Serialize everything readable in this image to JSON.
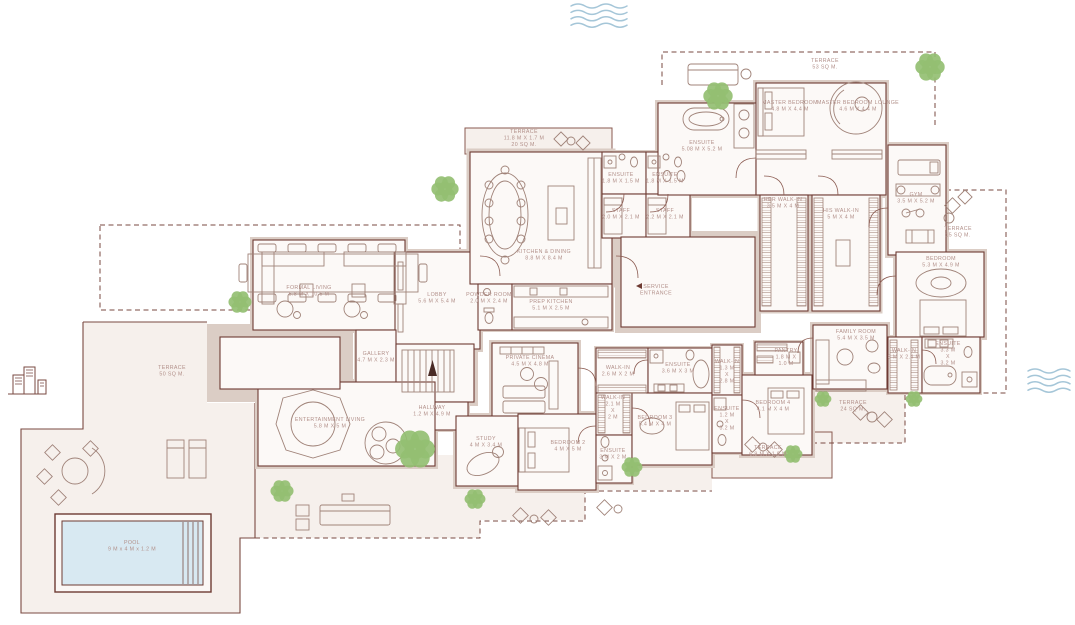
{
  "colors": {
    "wall": "#6e3b33",
    "wall_fill": "#dbcdc5",
    "room_fill": "#fcf9f7",
    "ground": "#f6f0ec",
    "label_text": "#b2908a",
    "tree_green": "#94bf72",
    "pool_water": "#d8e9f2",
    "wave_blue": "#a5c6d8"
  },
  "plan": {
    "labels": [
      {
        "id": "terrace-left",
        "lines": [
          "TERRACE",
          "50 SQ M."
        ],
        "x": 172,
        "y": 369
      },
      {
        "id": "formal-living",
        "lines": [
          "FORMAL LIVING",
          "5.8 M X 10.5 M"
        ],
        "x": 309,
        "y": 289
      },
      {
        "id": "gallery",
        "lines": [
          "GALLERY",
          "4.7 M X 2.3 M"
        ],
        "x": 376,
        "y": 355
      },
      {
        "id": "hallway",
        "lines": [
          "HALLWAY",
          "1.2 M X 4.9 M"
        ],
        "x": 432,
        "y": 409
      },
      {
        "id": "lobby",
        "lines": [
          "LOBBY",
          "5.6 M X 5.4 M"
        ],
        "x": 437,
        "y": 296
      },
      {
        "id": "entertainment-living",
        "lines": [
          "ENTERTAINMENT LIVING",
          "5.8 M X 5 M"
        ],
        "x": 330,
        "y": 421
      },
      {
        "id": "powder-room",
        "lines": [
          "POWDER ROOM",
          "2.0 M X 2.4 M"
        ],
        "x": 489,
        "y": 296
      },
      {
        "id": "prep-kitchen",
        "lines": [
          "PREP KITCHEN",
          "5.1 M X 2.5 M"
        ],
        "x": 551,
        "y": 303
      },
      {
        "id": "kitchen-dining",
        "lines": [
          "KITCHEN & DINING",
          "8.8 M X 8.4 M"
        ],
        "x": 544,
        "y": 253
      },
      {
        "id": "terrace-kitchen",
        "lines": [
          "TERRACE",
          "11.8 M X 1.7 M",
          "20 SQ M."
        ],
        "x": 524,
        "y": 133
      },
      {
        "id": "ensuite-staff-left",
        "lines": [
          "ENSUITE",
          "1.8 M X 1.5 M"
        ],
        "x": 621,
        "y": 176
      },
      {
        "id": "ensuite-staff-right",
        "lines": [
          "ENSUITE",
          "1.8 M X 1.5 M"
        ],
        "x": 665,
        "y": 176
      },
      {
        "id": "staff-left",
        "lines": [
          "STAFF",
          "2.0 M X 2.1 M"
        ],
        "x": 621,
        "y": 212
      },
      {
        "id": "staff-right",
        "lines": [
          "STAFF",
          "2.2 M X 2.1 M"
        ],
        "x": 665,
        "y": 212
      },
      {
        "id": "service-entrance",
        "lines": [
          "SERVICE",
          "ENTRANCE"
        ],
        "x": 656,
        "y": 288,
        "arrow": "left"
      },
      {
        "id": "master-bedroom",
        "lines": [
          "MASTER BEDROOM",
          "4.8 M X 4.4 M"
        ],
        "x": 790,
        "y": 104
      },
      {
        "id": "master-bedroom-lounge",
        "lines": [
          "MASTER BEDROOM LOUNGE",
          "4.6 M X 4.4 M"
        ],
        "x": 858,
        "y": 104
      },
      {
        "id": "terrace-master",
        "lines": [
          "TERRACE",
          "53 SQ M."
        ],
        "x": 825,
        "y": 62
      },
      {
        "id": "ensuite-master",
        "lines": [
          "ENSUITE",
          "5.08 M X 5.2 M"
        ],
        "x": 702,
        "y": 144
      },
      {
        "id": "her-walk-in",
        "lines": [
          "HER WALK-IN",
          "3.5 M X 4 M"
        ],
        "x": 783,
        "y": 201
      },
      {
        "id": "his-walk-in",
        "lines": [
          "HIS WALK-IN",
          "5 M X 4 M"
        ],
        "x": 841,
        "y": 212
      },
      {
        "id": "gym",
        "lines": [
          "GYM",
          "3.5 M X 5.2 M"
        ],
        "x": 916,
        "y": 196
      },
      {
        "id": "terrace-gym",
        "lines": [
          "TERRACE",
          "15 SQ M."
        ],
        "x": 958,
        "y": 230
      },
      {
        "id": "bedroom-right",
        "lines": [
          "BEDROOM",
          "5.3 M X 4.9 M"
        ],
        "x": 941,
        "y": 260
      },
      {
        "id": "walk-in-bedroom-right",
        "lines": [
          "WALK-IN",
          "3 M X 2.4 M"
        ],
        "x": 904,
        "y": 352
      },
      {
        "id": "ensuite-bedroom-right",
        "lines": [
          "ENSUITE",
          "3.3 M",
          "X",
          "3.2 M"
        ],
        "x": 948,
        "y": 345
      },
      {
        "id": "family-room",
        "lines": [
          "FAMILY ROOM",
          "5.4 M X 3.5 M"
        ],
        "x": 856,
        "y": 333
      },
      {
        "id": "pantry",
        "lines": [
          "PANTRY",
          "1.8 M X",
          "1.0 M"
        ],
        "x": 786,
        "y": 352
      },
      {
        "id": "bedroom-4",
        "lines": [
          "BEDROOM 4",
          "4.1 M X 4 M"
        ],
        "x": 773,
        "y": 404
      },
      {
        "id": "walk-in-4",
        "lines": [
          "WALK-IN",
          "1.3 M",
          "X",
          "2.8 M"
        ],
        "x": 727,
        "y": 363
      },
      {
        "id": "ensuite-4",
        "lines": [
          "ENSUITE",
          "1.2 M",
          "X",
          "3.2 M"
        ],
        "x": 727,
        "y": 410
      },
      {
        "id": "bedroom-3",
        "lines": [
          "BEDROOM 3",
          "5.4 M X 4 M"
        ],
        "x": 655,
        "y": 419
      },
      {
        "id": "ensuite-3",
        "lines": [
          "ENSUITE",
          "3.6 M X 3 M"
        ],
        "x": 678,
        "y": 366
      },
      {
        "id": "walk-in-3",
        "lines": [
          "WALK-IN",
          "2.6 M X 2 M"
        ],
        "x": 618,
        "y": 369
      },
      {
        "id": "walk-in-2",
        "lines": [
          "WALK-IN",
          "2.1 M",
          "X",
          "2 M"
        ],
        "x": 613,
        "y": 399
      },
      {
        "id": "ensuite-2",
        "lines": [
          "ENSUITE",
          "3 M X 2 M"
        ],
        "x": 613,
        "y": 452
      },
      {
        "id": "bedroom-2",
        "lines": [
          "BEDROOM 2",
          "4 M X 5 M"
        ],
        "x": 568,
        "y": 444
      },
      {
        "id": "study",
        "lines": [
          "STUDY",
          "4 M X 3.4 M"
        ],
        "x": 486,
        "y": 440
      },
      {
        "id": "private-cinema",
        "lines": [
          "PRIVATE CINEMA",
          "4.5 M X 4.8 M"
        ],
        "x": 530,
        "y": 359
      },
      {
        "id": "terrace-bedrooms",
        "lines": [
          "TERRACE",
          "6.9 M X 1.8 M"
        ],
        "x": 768,
        "y": 449
      },
      {
        "id": "terrace-family",
        "lines": [
          "TERRACE",
          "24 SQ M."
        ],
        "x": 853,
        "y": 404
      },
      {
        "id": "pool",
        "lines": [
          "POOL",
          "9 M x 4 M x 1.2 M"
        ],
        "x": 132,
        "y": 544
      }
    ],
    "trees": [
      {
        "x": 445,
        "y": 189,
        "r": 13
      },
      {
        "x": 240,
        "y": 302,
        "r": 11
      },
      {
        "x": 718,
        "y": 96,
        "r": 14
      },
      {
        "x": 930,
        "y": 67,
        "r": 14
      },
      {
        "x": 415,
        "y": 449,
        "r": 19
      },
      {
        "x": 282,
        "y": 491,
        "r": 11
      },
      {
        "x": 475,
        "y": 499,
        "r": 10
      },
      {
        "x": 632,
        "y": 467,
        "r": 10
      },
      {
        "x": 793,
        "y": 454,
        "r": 9
      },
      {
        "x": 823,
        "y": 399,
        "r": 8
      },
      {
        "x": 914,
        "y": 399,
        "r": 8
      }
    ],
    "waves": [
      {
        "x": 571,
        "y": 6,
        "w": 56,
        "rows": 4
      },
      {
        "x": 1028,
        "y": 371,
        "w": 40,
        "rows": 4
      }
    ]
  }
}
